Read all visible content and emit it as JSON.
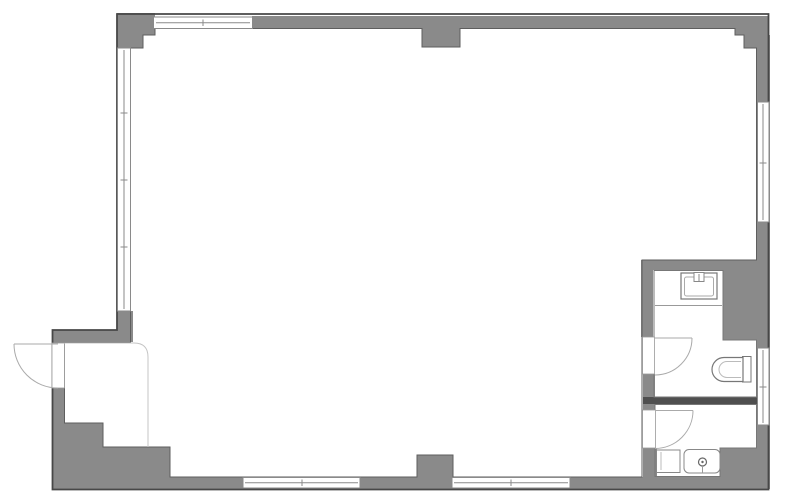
{
  "page": {
    "title": "architectural-floor-plan",
    "type": "vacant-room-floor-plan"
  },
  "colors": {
    "background": "#ffffff",
    "wall": "#8a8a8a",
    "wall_dark": "#4f4f4f",
    "outer_outline": "#474747",
    "room_outline": "#5e5e5e",
    "thin_line": "#777777",
    "fixture_line": "#888888",
    "fixture_detail": "#bbbbbb",
    "swing_line": "#aaaaaa",
    "light_line": "#c4c4c4",
    "window_fill": "#ffffff",
    "window_line": "#8a8a8a"
  },
  "floor_plan": {
    "rooms": [
      {
        "name": "main-room"
      },
      {
        "name": "toilet-room"
      },
      {
        "name": "kitchenette-room"
      },
      {
        "name": "entry-area"
      }
    ],
    "windows": [
      "window-top",
      "window-left",
      "window-right-upper",
      "window-right-lower",
      "window-bottom-left",
      "window-bottom-right"
    ],
    "doors": [
      "entrance-door-outward-swing",
      "toilet-room-door",
      "kitchenette-room-door"
    ],
    "fixtures": [
      "washbasin",
      "toilet",
      "kitchen-sink",
      "kitchen-unit"
    ]
  }
}
